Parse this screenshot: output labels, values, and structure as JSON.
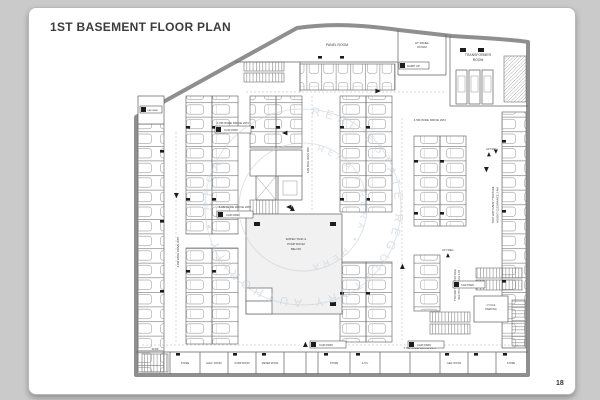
{
  "page": {
    "title": "1ST BASEMENT FLOOR PLAN",
    "page_number": "18"
  },
  "colors": {
    "background": "#cacaca",
    "card": "#ffffff",
    "wall_gray": "#8f8f8f",
    "line_gray": "#5f5f5f",
    "marker_black": "#1d1d1d",
    "watermark": "#c2ccd4"
  },
  "watermark": {
    "ring_text": "REAL ESTATE REGULATORY AUTHORITY  •  RERA",
    "inner_text": "RERA  •  RERA  •  RERA"
  },
  "rooms": {
    "panel_room": "PANEL ROOM",
    "ht_panel_1": "HT PANEL",
    "ht_panel_2": "ROOM",
    "transformer_1": "TRANSFORMER",
    "transformer_2": "ROOM",
    "water_tank_1": "WATER TANK &",
    "water_tank_2": "PUMP ROOM",
    "water_tank_3": "BELOW",
    "lift_well": "LIFT WELL",
    "stair": "STAIR",
    "cycle_1": "CYCLE",
    "cycle_2": "PARKING",
    "bottom_rooms": [
      "STORE",
      "ELEC. ROOM",
      "PUMP ROOM",
      "METER ROOM",
      "STORE",
      "A.H.U",
      "GEN. ROOM",
      "STORE"
    ]
  },
  "labels": {
    "drive_6m": "6.0M WIDE DRIVE WAY",
    "drive_45m": "4.5M WIDE DRIVE WAY",
    "drive_75m": "7.5M WIDE DRIVE WAY",
    "ramp_1": "TWO WAY RAMP 7.5M WIDE",
    "ramp_2": "HEIGHT CLEARANCE 2.4M",
    "ramp_up": "RAMP UP",
    "car_badge": "CAR PARK"
  }
}
